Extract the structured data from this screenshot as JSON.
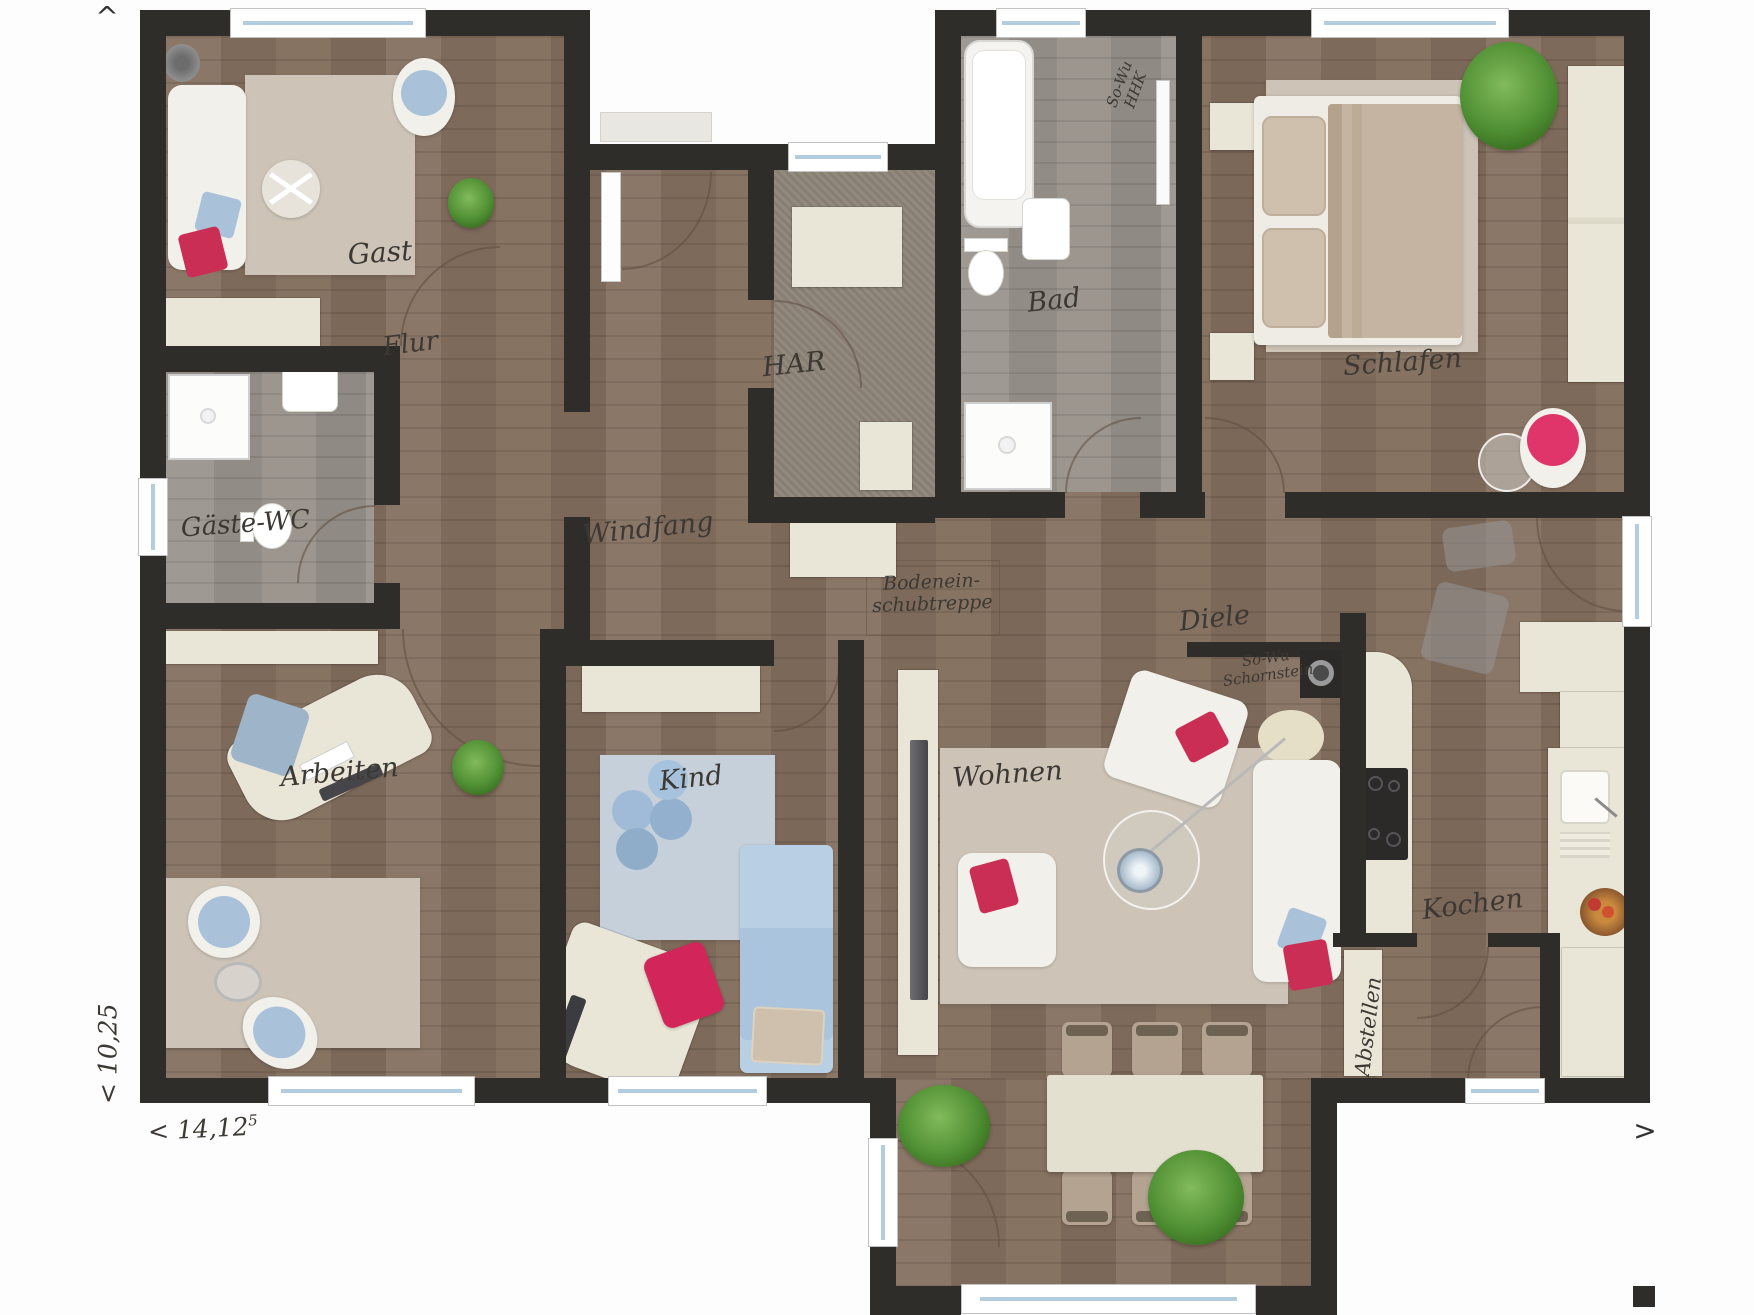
{
  "rooms": {
    "gast": {
      "label": "Gast"
    },
    "flur": {
      "label": "Flur"
    },
    "gaeste_wc": {
      "label": "Gäste-WC"
    },
    "arbeiten": {
      "label": "Arbeiten"
    },
    "windfang": {
      "label": "Windfang"
    },
    "har": {
      "label": "HAR"
    },
    "bad": {
      "label": "Bad"
    },
    "schlafen": {
      "label": "Schlafen"
    },
    "diele": {
      "label": "Diele"
    },
    "kind": {
      "label": "Kind"
    },
    "wohnen": {
      "label": "Wohnen"
    },
    "kochen": {
      "label": "Kochen"
    },
    "abstellen": {
      "label": "Abstellen"
    }
  },
  "annotations": {
    "attic_stairs": {
      "line1": "Bodenein-",
      "line2": "schubtreppe"
    },
    "bath_radiator": {
      "line1": "So-Wu",
      "line2": "HHK"
    },
    "chimney": {
      "line1": "So-Wu",
      "line2": "Schornstein"
    }
  },
  "dimensions": {
    "depth": "< 10,25",
    "width": "< 14,12",
    "width_exponent": "5"
  },
  "compass": {
    "top": "^",
    "right": ">"
  },
  "colors": {
    "wall": "#2f2d2a",
    "wood_floor": "#85705f",
    "tile_floor": "#9a948d",
    "accent_red": "#cb2e55",
    "accent_blue": "#a9c2da",
    "cabinet_beige": "#e9e6d7"
  }
}
